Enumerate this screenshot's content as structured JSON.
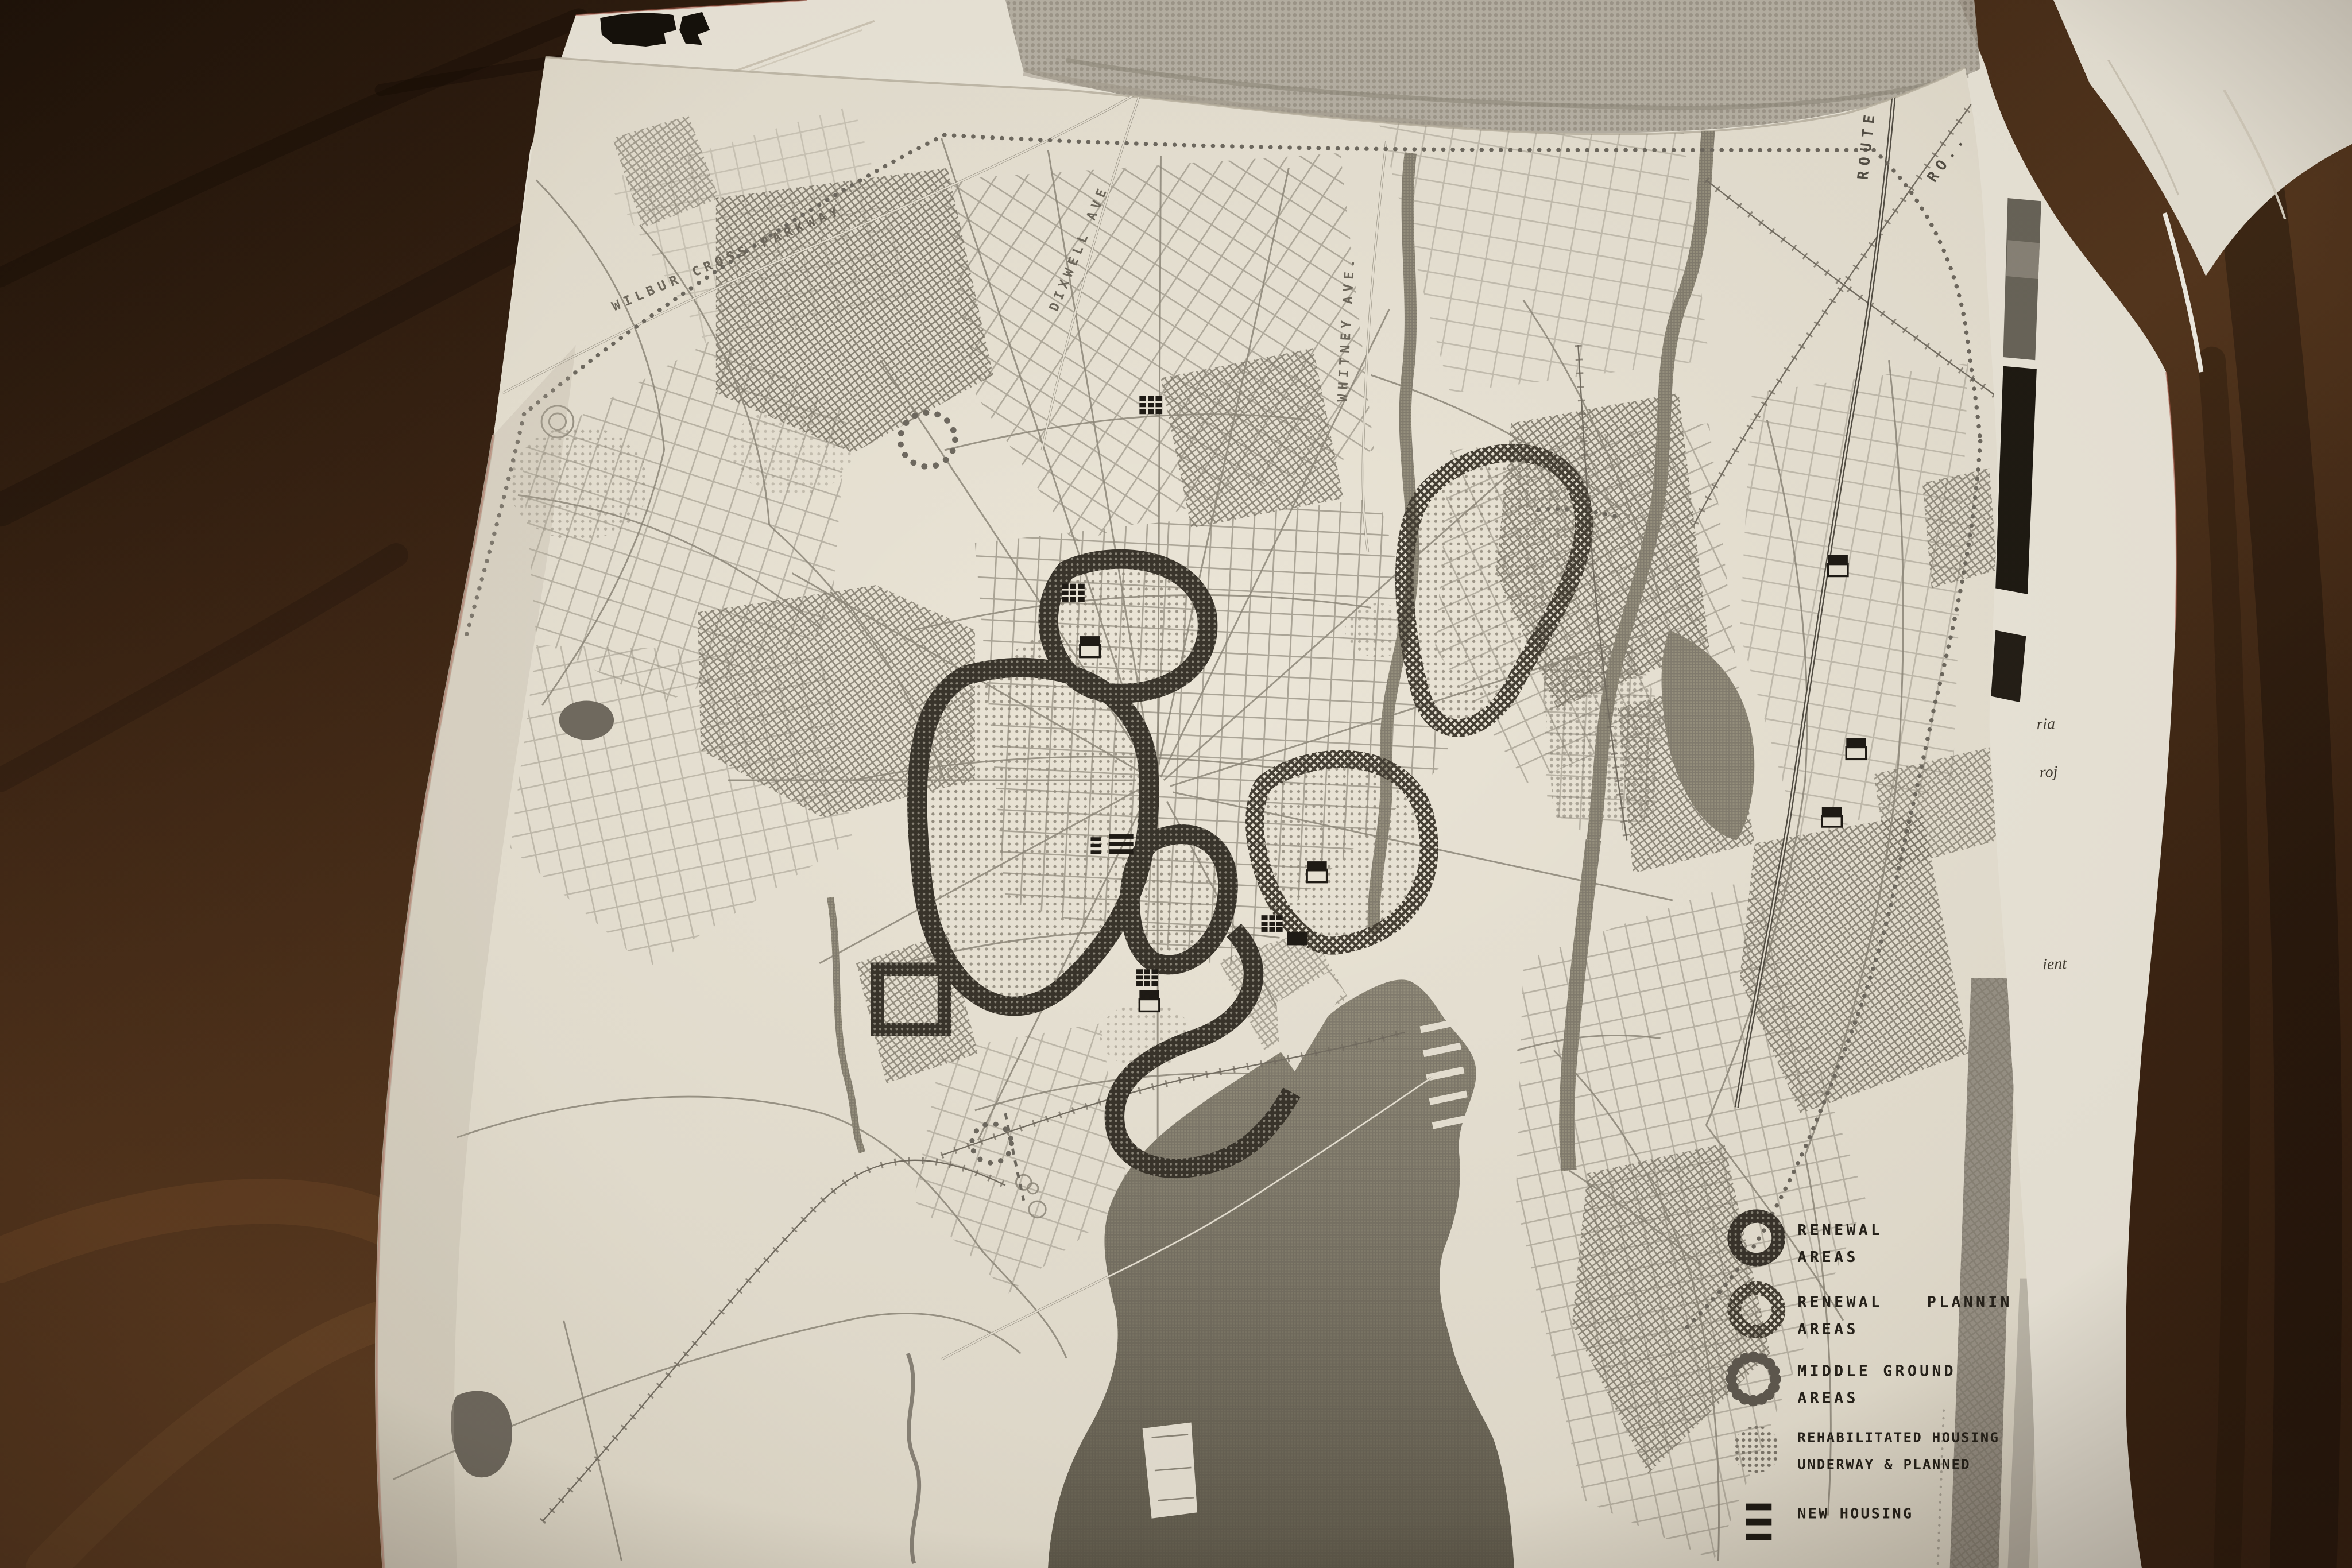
{
  "map": {
    "road_labels": {
      "wilbur_cross_parkway": "WILBUR CROSS PARKWAY",
      "dixwell_ave": "DIXWELL AVE",
      "whitney_ave": "WHITNEY AVE.",
      "route_91": "ROUTE 91",
      "partial_road_ro": "RO.."
    },
    "legend": {
      "items": [
        {
          "icon": "renewal-ring-icon",
          "line1": "RENEWAL",
          "line2": "AREAS"
        },
        {
          "icon": "renewal-planning-ring-icon",
          "line1": "RENEWAL",
          "line1b": "PLANNIN",
          "line2": "AREAS"
        },
        {
          "icon": "middle-ground-ring-icon",
          "line1": "MIDDLE GROUND",
          "line2": "AREAS"
        },
        {
          "icon": "rehabilitated-housing-disc-icon",
          "line1": "REHABILITATED HOUSING",
          "line2": "UNDERWAY & PLANNED"
        },
        {
          "icon": "new-housing-bars-icon",
          "line1": "NEW HOUSING",
          "line2": ""
        }
      ]
    }
  },
  "adjacent_page": {
    "fragment_1": "ria",
    "fragment_2": "roj",
    "fragment_3": "ient"
  },
  "colors": {
    "paper": "#e8e2d4",
    "underlying_paper": "#ede8dc",
    "map_line": "#8d8779",
    "ink_dark": "#221e18",
    "ring_dark": "#39342b",
    "water_gray": "#8f897d",
    "photo_gray": "#b2ac9f",
    "wood_dark": "#2c1b0e",
    "wood_mid": "#4f3420"
  }
}
